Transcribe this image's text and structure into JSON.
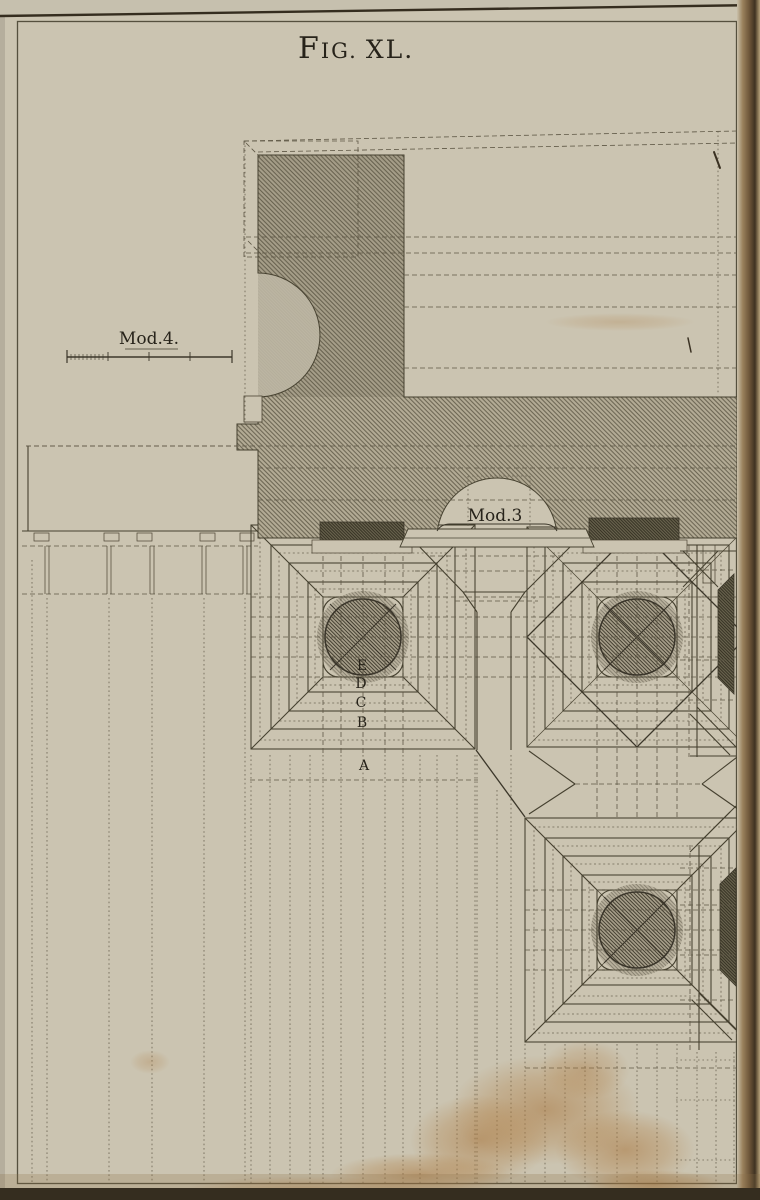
{
  "page": {
    "background": "#cbc4b1",
    "margin_tone": "#c6c0ae",
    "ink": "#45402f",
    "frame_line": "#55503e",
    "hatch_base": "#b3ab95",
    "stain": "#b07f45",
    "gutter_dark": "#4e3d28",
    "edge_dark": "#352d1f"
  },
  "title": {
    "text": "FIG. XL.",
    "parts": [
      "F",
      "IG.",
      "XL."
    ]
  },
  "labels": {
    "scale_module_4": "Mod.4.",
    "scale_module_3": "Mod.3",
    "plinth_steps": [
      "E",
      "D",
      "C",
      "B",
      "A"
    ]
  }
}
